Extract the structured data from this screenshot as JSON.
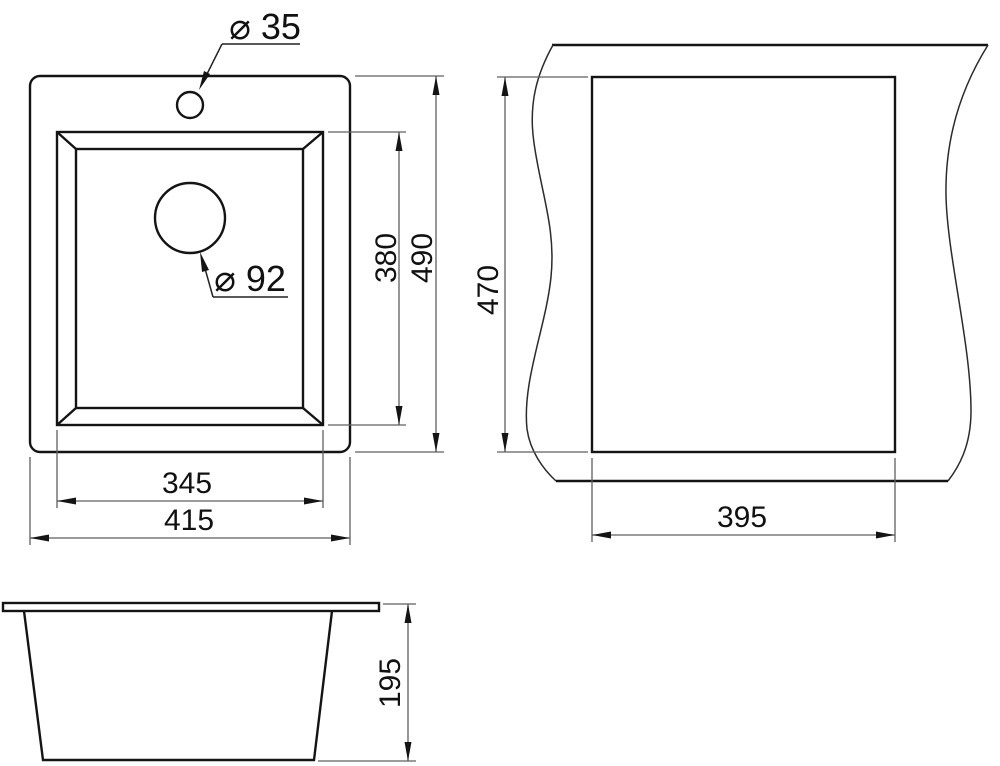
{
  "colors": {
    "object_line": "#141414",
    "dimension_line": "#5f5f5f",
    "text": "#111111",
    "background": "#ffffff"
  },
  "top_view": {
    "faucet_hole_label": "⌀ 35",
    "drain_hole_label": "⌀ 92",
    "dim_inner_width": "345",
    "dim_overall_width": "415",
    "dim_inner_depth": "380",
    "dim_overall_depth": "490"
  },
  "cutout_view": {
    "dim_cutout_depth": "470",
    "dim_cutout_width": "395"
  },
  "side_view": {
    "dim_overall_height": "195"
  }
}
